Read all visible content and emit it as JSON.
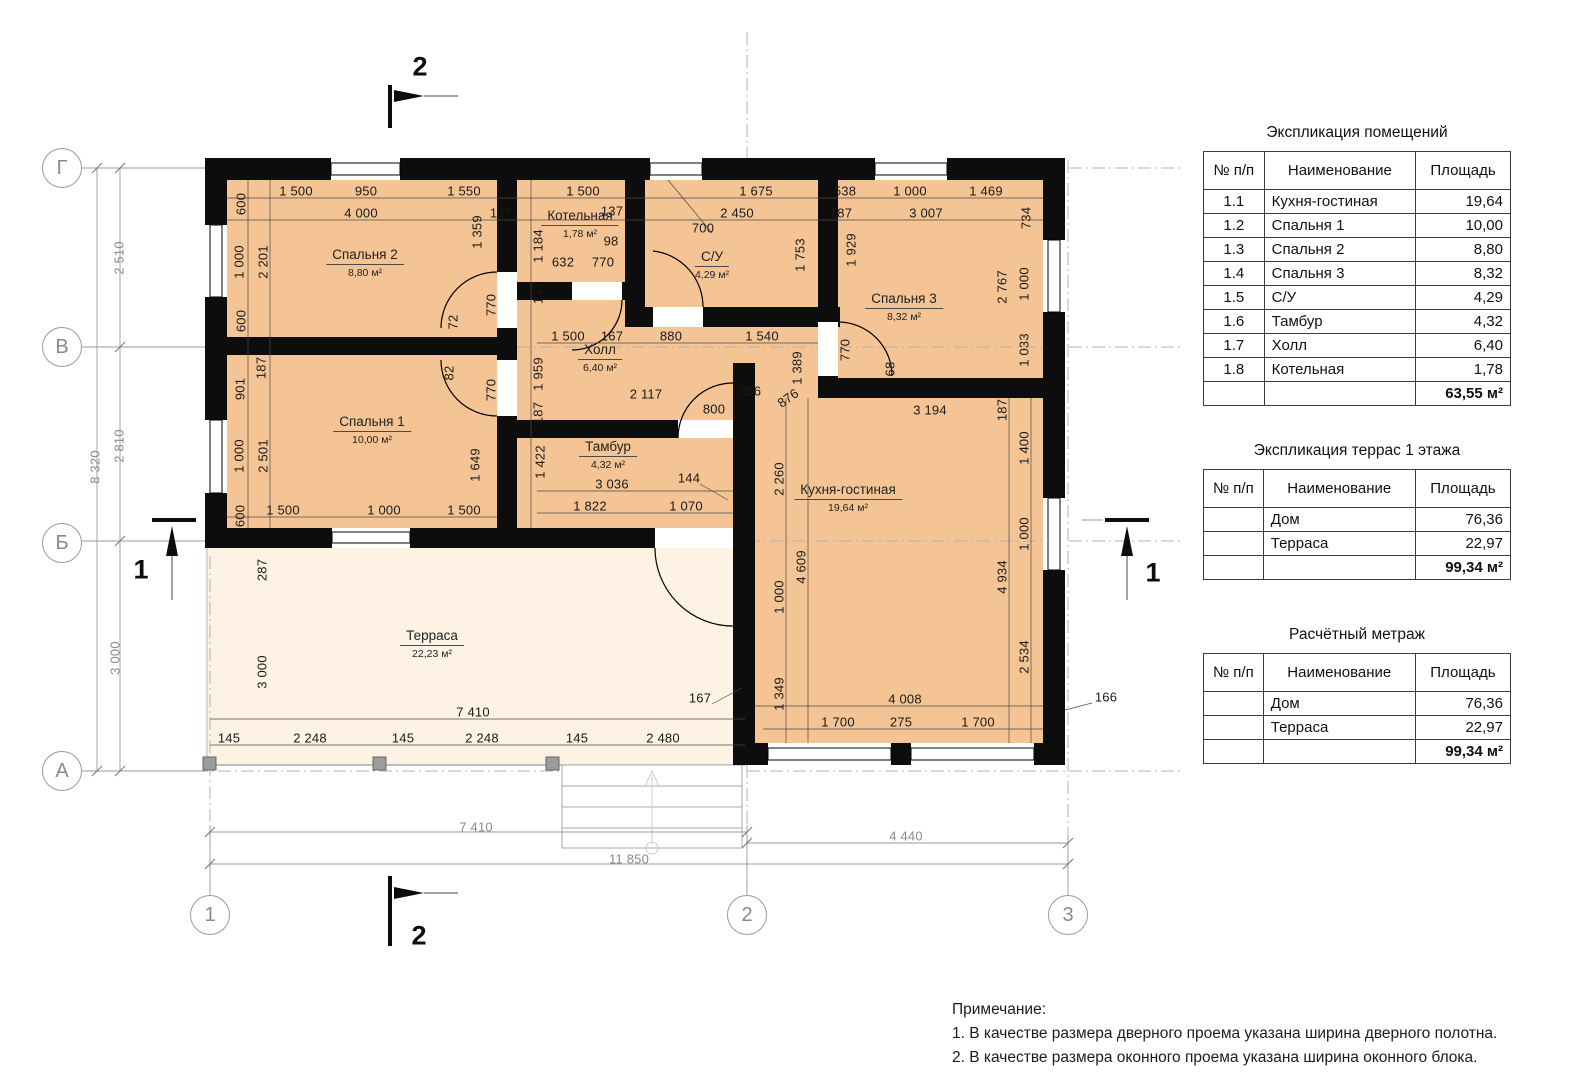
{
  "plan": {
    "rooms": [
      {
        "name": "Спальня 2",
        "area": "8,80 м²",
        "x": 365,
        "y": 263
      },
      {
        "name": "Котельная",
        "area": "1,78 м²",
        "x": 580,
        "y": 224
      },
      {
        "name": "С/У",
        "area": "4,29 м²",
        "x": 712,
        "y": 265
      },
      {
        "name": "Спальня 3",
        "area": "8,32 м²",
        "x": 904,
        "y": 307
      },
      {
        "name": "Холл",
        "area": "6,40 м²",
        "x": 600,
        "y": 358
      },
      {
        "name": "Спальня 1",
        "area": "10,00 м²",
        "x": 372,
        "y": 430
      },
      {
        "name": "Тамбур",
        "area": "4,32 м²",
        "x": 608,
        "y": 455
      },
      {
        "name": "Кухня-гостиная",
        "area": "19,64 м²",
        "x": 848,
        "y": 498
      },
      {
        "name": "Терраса",
        "area": "22,23 м²",
        "x": 432,
        "y": 644
      }
    ],
    "dimensions": [
      {
        "t": "1 500",
        "x": 296,
        "y": 191
      },
      {
        "t": "950",
        "x": 366,
        "y": 191
      },
      {
        "t": "1 550",
        "x": 464,
        "y": 191
      },
      {
        "t": "1 500",
        "x": 583,
        "y": 191
      },
      {
        "t": "7",
        "x": 628,
        "y": 191
      },
      {
        "t": "1 675",
        "x": 756,
        "y": 191
      },
      {
        "t": "538",
        "x": 845,
        "y": 191
      },
      {
        "t": "1 000",
        "x": 910,
        "y": 191
      },
      {
        "t": "1 469",
        "x": 986,
        "y": 191
      },
      {
        "t": "4 000",
        "x": 361,
        "y": 213
      },
      {
        "t": "137",
        "x": 501,
        "y": 213
      },
      {
        "t": "137",
        "x": 612,
        "y": 211
      },
      {
        "t": "2 450",
        "x": 737,
        "y": 213
      },
      {
        "t": "187",
        "x": 841,
        "y": 213
      },
      {
        "t": "3 007",
        "x": 926,
        "y": 213
      },
      {
        "t": "734",
        "x": 1026,
        "y": 218,
        "r": 90
      },
      {
        "t": "600",
        "x": 241,
        "y": 204,
        "r": 90
      },
      {
        "t": "1 000",
        "x": 239,
        "y": 262,
        "r": 90
      },
      {
        "t": "2 201",
        "x": 263,
        "y": 262,
        "r": 90
      },
      {
        "t": "600",
        "x": 241,
        "y": 321,
        "r": 90
      },
      {
        "t": "1 359",
        "x": 477,
        "y": 232,
        "r": 90
      },
      {
        "t": "1 184",
        "x": 538,
        "y": 246,
        "r": 90
      },
      {
        "t": "1 929",
        "x": 851,
        "y": 250,
        "r": 90
      },
      {
        "t": "2 767",
        "x": 1002,
        "y": 287,
        "r": 90
      },
      {
        "t": "1 000",
        "x": 1024,
        "y": 284,
        "r": 90
      },
      {
        "t": "1 033",
        "x": 1024,
        "y": 350,
        "r": 90
      },
      {
        "t": "1 753",
        "x": 800,
        "y": 255,
        "r": 90
      },
      {
        "t": "98",
        "x": 611,
        "y": 241
      },
      {
        "t": "632",
        "x": 563,
        "y": 262
      },
      {
        "t": "770",
        "x": 603,
        "y": 262
      },
      {
        "t": "137",
        "x": 538,
        "y": 293,
        "r": 90
      },
      {
        "t": "700",
        "x": 703,
        "y": 228
      },
      {
        "t": "72",
        "x": 453,
        "y": 322,
        "r": 90
      },
      {
        "t": "770",
        "x": 491,
        "y": 305,
        "r": 90
      },
      {
        "t": "82",
        "x": 449,
        "y": 373,
        "r": 90
      },
      {
        "t": "770",
        "x": 491,
        "y": 390,
        "r": 90
      },
      {
        "t": "770",
        "x": 845,
        "y": 350,
        "r": 90
      },
      {
        "t": "68",
        "x": 890,
        "y": 369,
        "r": 90
      },
      {
        "t": "1 500",
        "x": 568,
        "y": 336
      },
      {
        "t": "167",
        "x": 612,
        "y": 336
      },
      {
        "t": "880",
        "x": 671,
        "y": 336
      },
      {
        "t": "1 540",
        "x": 762,
        "y": 336
      },
      {
        "t": "187",
        "x": 261,
        "y": 368,
        "r": 90
      },
      {
        "t": "901",
        "x": 240,
        "y": 389,
        "r": 90
      },
      {
        "t": "1 000",
        "x": 239,
        "y": 456,
        "r": 90
      },
      {
        "t": "2 501",
        "x": 263,
        "y": 456,
        "r": 90
      },
      {
        "t": "600",
        "x": 240,
        "y": 516,
        "r": 90
      },
      {
        "t": "1 649",
        "x": 475,
        "y": 465,
        "r": 90
      },
      {
        "t": "1 959",
        "x": 538,
        "y": 374,
        "r": 90
      },
      {
        "t": "187",
        "x": 538,
        "y": 413,
        "r": 90
      },
      {
        "t": "1 422",
        "x": 540,
        "y": 462,
        "r": 90
      },
      {
        "t": "1 389",
        "x": 797,
        "y": 368,
        "r": 90
      },
      {
        "t": "876",
        "x": 788,
        "y": 398,
        "r": 35
      },
      {
        "t": "2 117",
        "x": 646,
        "y": 394
      },
      {
        "t": "356",
        "x": 750,
        "y": 391
      },
      {
        "t": "800",
        "x": 714,
        "y": 409
      },
      {
        "t": "3 036",
        "x": 612,
        "y": 484
      },
      {
        "t": "144",
        "x": 689,
        "y": 478
      },
      {
        "t": "1 822",
        "x": 590,
        "y": 506
      },
      {
        "t": "1 070",
        "x": 686,
        "y": 506
      },
      {
        "t": "1 500",
        "x": 283,
        "y": 510
      },
      {
        "t": "1 000",
        "x": 384,
        "y": 510
      },
      {
        "t": "1 500",
        "x": 464,
        "y": 510
      },
      {
        "t": "3 194",
        "x": 930,
        "y": 410
      },
      {
        "t": "187",
        "x": 1002,
        "y": 410,
        "r": 90
      },
      {
        "t": "2 260",
        "x": 779,
        "y": 479,
        "r": 90
      },
      {
        "t": "1 000",
        "x": 779,
        "y": 597,
        "r": 90
      },
      {
        "t": "1 349",
        "x": 779,
        "y": 694,
        "r": 90
      },
      {
        "t": "4 609",
        "x": 801,
        "y": 567,
        "r": 90
      },
      {
        "t": "1 400",
        "x": 1024,
        "y": 448,
        "r": 90
      },
      {
        "t": "1 000",
        "x": 1024,
        "y": 534,
        "r": 90
      },
      {
        "t": "4 934",
        "x": 1002,
        "y": 577,
        "r": 90
      },
      {
        "t": "2 534",
        "x": 1024,
        "y": 657,
        "r": 90
      },
      {
        "t": "287",
        "x": 262,
        "y": 570,
        "r": 90
      },
      {
        "t": "3 000",
        "x": 262,
        "y": 672,
        "r": 90
      },
      {
        "t": "7 410",
        "x": 473,
        "y": 712
      },
      {
        "t": "145",
        "x": 229,
        "y": 738
      },
      {
        "t": "2 248",
        "x": 310,
        "y": 738
      },
      {
        "t": "145",
        "x": 403,
        "y": 738
      },
      {
        "t": "2 248",
        "x": 482,
        "y": 738
      },
      {
        "t": "145",
        "x": 577,
        "y": 738
      },
      {
        "t": "2 480",
        "x": 663,
        "y": 738
      },
      {
        "t": "4 008",
        "x": 905,
        "y": 699
      },
      {
        "t": "1 700",
        "x": 838,
        "y": 722
      },
      {
        "t": "275",
        "x": 901,
        "y": 722
      },
      {
        "t": "1 700",
        "x": 978,
        "y": 722
      },
      {
        "t": "167",
        "x": 700,
        "y": 698
      },
      {
        "t": "166",
        "x": 1106,
        "y": 697
      },
      {
        "t": "2 510",
        "x": 119,
        "y": 258,
        "r": 90,
        "c": 1
      },
      {
        "t": "2 810",
        "x": 119,
        "y": 446,
        "r": 90,
        "c": 1
      },
      {
        "t": "3 000",
        "x": 115,
        "y": 658,
        "r": 90,
        "c": 1
      },
      {
        "t": "8 320",
        "x": 95,
        "y": 467,
        "r": 90,
        "c": 1
      },
      {
        "t": "7 410",
        "x": 476,
        "y": 827,
        "c": 1
      },
      {
        "t": "4 440",
        "x": 906,
        "y": 836,
        "c": 1
      },
      {
        "t": "11 850",
        "x": 629,
        "y": 859,
        "c": 1
      }
    ],
    "axes": [
      {
        "label": "Г",
        "x": 62,
        "y": 168
      },
      {
        "label": "В",
        "x": 62,
        "y": 347
      },
      {
        "label": "Б",
        "x": 62,
        "y": 543
      },
      {
        "label": "А",
        "x": 62,
        "y": 771
      },
      {
        "label": "1",
        "x": 210,
        "y": 915
      },
      {
        "label": "2",
        "x": 747,
        "y": 915
      },
      {
        "label": "3",
        "x": 1068,
        "y": 915
      }
    ],
    "section_markers": [
      {
        "label": "2",
        "x": 420,
        "y": 67
      },
      {
        "label": "2",
        "x": 419,
        "y": 936
      },
      {
        "label": "1",
        "x": 141,
        "y": 570
      },
      {
        "label": "1",
        "x": 1153,
        "y": 573
      }
    ]
  },
  "tables": [
    {
      "title": "Экспликация помещений",
      "cols": [
        "№ п/п",
        "Наименование",
        "Площадь"
      ],
      "rows": [
        [
          "1.1",
          "Кухня-гостиная",
          "19,64"
        ],
        [
          "1.2",
          "Спальня 1",
          "10,00"
        ],
        [
          "1.3",
          "Спальня 2",
          "8,80"
        ],
        [
          "1.4",
          "Спальня 3",
          "8,32"
        ],
        [
          "1.5",
          "С/У",
          "4,29"
        ],
        [
          "1.6",
          "Тамбур",
          "4,32"
        ],
        [
          "1.7",
          "Холл",
          "6,40"
        ],
        [
          "1.8",
          "Котельная",
          "1,78"
        ]
      ],
      "total": "63,55 м²",
      "top": 124
    },
    {
      "title": "Экспликация террас 1 этажа",
      "cols": [
        "№ п/п",
        "Наименование",
        "Площадь"
      ],
      "rows": [
        [
          "",
          "Дом",
          "76,36"
        ],
        [
          "",
          "Терраса",
          "22,97"
        ]
      ],
      "total": "99,34 м²",
      "top": 442
    },
    {
      "title": "Расчётный метраж",
      "cols": [
        "№ п/п",
        "Наименование",
        "Площадь"
      ],
      "rows": [
        [
          "",
          "Дом",
          "76,36"
        ],
        [
          "",
          "Терраса",
          "22,97"
        ]
      ],
      "total": "99,34 м²",
      "top": 626
    }
  ],
  "notes": {
    "title": "Примечание:",
    "lines": [
      "1. В качестве размера дверного проема указана ширина дверного полотна.",
      "2. В качестве размера оконного проема указана ширина оконного блока."
    ]
  },
  "colors": {
    "room_fill": "#f4c494",
    "terrace_fill": "#fdf2e4",
    "wall": "#0d0d0d",
    "axis_gray": "#9a9a9a"
  }
}
